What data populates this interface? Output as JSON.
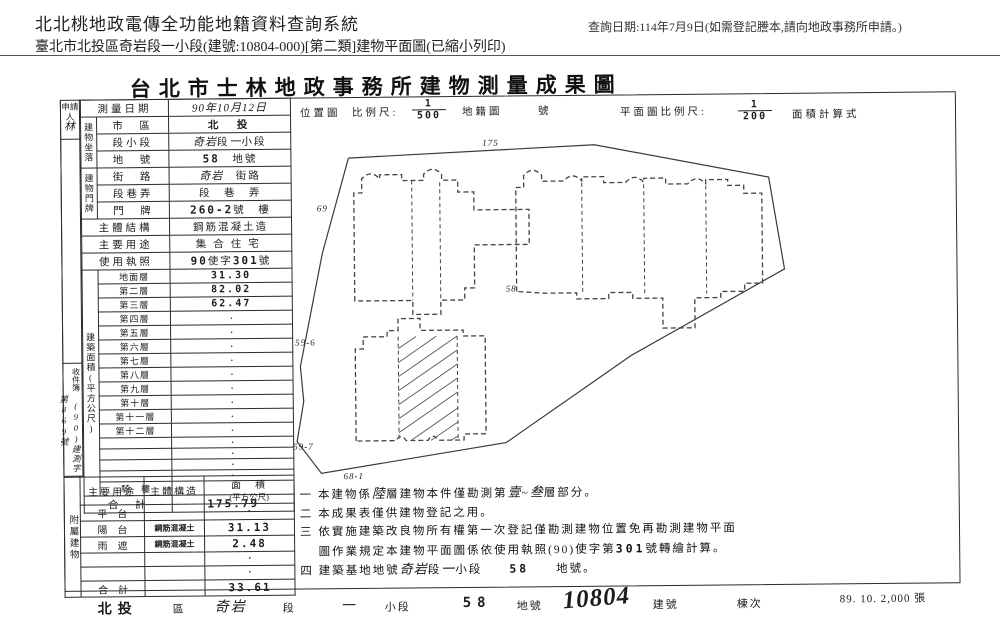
{
  "page_header": {
    "system_title": "北北桃地政電傳全功能地籍資料查詢系統",
    "subtitle": "臺北市北投區奇岩段一小段(建號:10804-000)[第二類]建物平面圖(已縮小列印)",
    "query_date_note": "查詢日期:114年7月9日(如需登記謄本,請向地政事務所申請。)"
  },
  "form": {
    "title": "台北市士林地政事務所建物測量成果圖",
    "applicant": {
      "label": "申請人",
      "name": "林"
    },
    "receipt": {
      "label": "收件簿",
      "number": "(90)建測字第869號"
    },
    "main_table": {
      "rows": [
        {
          "label": "測量日期",
          "wide": true,
          "segs": [
            {
              "t": "90年10月12日",
              "s": "hand"
            }
          ]
        },
        {
          "group": {
            "label": "建物坐落",
            "span": 3
          },
          "label": "市　區",
          "segs": [
            {
              "t": "北　投",
              "s": "bold"
            }
          ]
        },
        {
          "label": "段小段",
          "segs": [
            {
              "t": "奇岩",
              "s": "hand"
            },
            {
              "t": "段",
              "s": "print"
            },
            {
              "t": "一",
              "s": "hand"
            },
            {
              "t": "小段",
              "s": "print"
            }
          ]
        },
        {
          "label": "地　號",
          "segs": [
            {
              "t": "58",
              "s": "mono"
            },
            {
              "t": "　地號",
              "s": "print"
            }
          ]
        },
        {
          "group": {
            "label": "建物門牌",
            "span": 3
          },
          "label": "街　路",
          "segs": [
            {
              "t": "奇岩",
              "s": "hand"
            },
            {
              "t": "　街路",
              "s": "print"
            }
          ]
        },
        {
          "label": "段巷弄",
          "segs": [
            {
              "t": "段　巷　弄",
              "s": "print"
            }
          ]
        },
        {
          "label": "門　牌",
          "segs": [
            {
              "t": "260-2",
              "s": "mono"
            },
            {
              "t": "號　樓",
              "s": "print"
            }
          ]
        },
        {
          "label": "主體結構",
          "wide": true,
          "segs": [
            {
              "t": "鋼筋混凝土造",
              "s": "print"
            }
          ]
        },
        {
          "label": "主要用途",
          "wide": true,
          "segs": [
            {
              "t": "集合住宅",
              "s": "spread"
            }
          ]
        },
        {
          "label": "使用執照",
          "wide": true,
          "segs": [
            {
              "t": "90",
              "s": "mono"
            },
            {
              "t": "使字",
              "s": "print"
            },
            {
              "t": "301",
              "s": "mono"
            },
            {
              "t": "號",
              "s": "print"
            }
          ]
        },
        {
          "group": {
            "label": "建築面積(平方公尺)",
            "span": 17
          },
          "label": "地面層",
          "c": 1,
          "segs": [
            {
              "t": "31.30",
              "s": "mono"
            }
          ]
        },
        {
          "label": "第二層",
          "c": 1,
          "segs": [
            {
              "t": "82.02",
              "s": "mono"
            }
          ]
        },
        {
          "label": "第三層",
          "c": 1,
          "segs": [
            {
              "t": "62.47",
              "s": "mono"
            }
          ]
        },
        {
          "label": "第四層",
          "c": 1,
          "segs": [
            {
              "t": "·",
              "s": "dot"
            }
          ]
        },
        {
          "label": "第五層",
          "c": 1,
          "segs": [
            {
              "t": "·",
              "s": "dot"
            }
          ]
        },
        {
          "label": "第六層",
          "c": 1,
          "segs": [
            {
              "t": "·",
              "s": "dot"
            }
          ]
        },
        {
          "label": "第七層",
          "c": 1,
          "segs": [
            {
              "t": "·",
              "s": "dot"
            }
          ]
        },
        {
          "label": "第八層",
          "c": 1,
          "segs": [
            {
              "t": "·",
              "s": "dot"
            }
          ]
        },
        {
          "label": "第九層",
          "c": 1,
          "segs": [
            {
              "t": "·",
              "s": "dot"
            }
          ]
        },
        {
          "label": "第十層",
          "c": 1,
          "segs": [
            {
              "t": "·",
              "s": "dot"
            }
          ]
        },
        {
          "label": "第十一層",
          "c": 1,
          "segs": [
            {
              "t": "·",
              "s": "dot"
            }
          ]
        },
        {
          "label": "第十二層",
          "c": 1,
          "segs": [
            {
              "t": "·",
              "s": "dot"
            }
          ]
        },
        {
          "label": "",
          "c": 1,
          "segs": [
            {
              "t": "·",
              "s": "dot"
            }
          ]
        },
        {
          "label": "",
          "c": 1,
          "segs": [
            {
              "t": "·",
              "s": "dot"
            }
          ]
        },
        {
          "label": "",
          "c": 1,
          "segs": [
            {
              "t": "·",
              "s": "dot"
            }
          ]
        },
        {
          "label": "",
          "c": 1,
          "segs": [
            {
              "t": "·",
              "s": "dot"
            }
          ]
        },
        {
          "label": "騎　樓",
          "c": 1,
          "segs": [
            {
              "t": "·",
              "s": "dot"
            }
          ]
        },
        {
          "label": "合　計",
          "wide": true,
          "segs": [
            {
              "t": "175.79",
              "s": "mono"
            }
          ]
        }
      ]
    },
    "annex_table": {
      "side_label": "附屬建物",
      "headers": {
        "usage": "主要用途",
        "structure": "主體構造",
        "area": "面　積",
        "area_unit": "(平方公尺)"
      },
      "rows": [
        {
          "usage": "平　台",
          "structure": "",
          "area": "·",
          "mono": false
        },
        {
          "usage": "陽　台",
          "structure": "鋼筋混凝土",
          "area": "31.13",
          "mono": true
        },
        {
          "usage": "雨　遮",
          "structure": "鋼筋混凝土",
          "area": "2.48",
          "mono": true
        },
        {
          "usage": "",
          "structure": "",
          "area": "·",
          "mono": false
        },
        {
          "usage": "",
          "structure": "",
          "area": "·",
          "mono": false
        },
        {
          "usage": "合　計",
          "structure": "",
          "area": "33.61",
          "mono": true
        }
      ]
    },
    "plan_header": {
      "location_map": "位置圖",
      "scale_label": "比例尺:",
      "location_scale": {
        "num": "1",
        "den": "500"
      },
      "cadastral_map": "地籍圖",
      "cadastral_no": "號",
      "plan_scale_label": "平面圖比例尺:",
      "plan_scale": {
        "num": "1",
        "den": "200"
      },
      "area_calc": "面積計算式"
    },
    "map_labels": [
      {
        "text": "175",
        "x": 192,
        "y": 42
      },
      {
        "text": "69",
        "x": 26,
        "y": 106
      },
      {
        "text": "59-6",
        "x": 3,
        "y": 240
      },
      {
        "text": "59-7",
        "x": 0,
        "y": 344
      },
      {
        "text": "68-1",
        "x": 50,
        "y": 374
      },
      {
        "text": "58",
        "x": 214,
        "y": 188
      }
    ],
    "notes": [
      [
        {
          "t": "一 本建物係 ",
          "s": "print"
        },
        {
          "t": "陸",
          "s": "hand"
        },
        {
          "t": " 層建物本件僅勘測第",
          "s": "print"
        },
        {
          "t": "壹",
          "s": "hand"
        },
        {
          "t": "~",
          "s": "print"
        },
        {
          "t": "叁",
          "s": "hand"
        },
        {
          "t": " 層部分。",
          "s": "print"
        }
      ],
      [
        {
          "t": "二 本成果表僅供建物登記之用。",
          "s": "print"
        }
      ],
      [
        {
          "t": "三 依實施建築改良物所有權第一次登記僅勘測建物位置免再勘測建物平面",
          "s": "print"
        }
      ],
      [
        {
          "t": "　 圖作業規定本建物平面圖係依使用執照(90)使字第 ",
          "s": "print"
        },
        {
          "t": "301",
          "s": "mono"
        },
        {
          "t": " 號轉繪計算。",
          "s": "print"
        }
      ],
      [
        {
          "t": "四 建築基地地號 ",
          "s": "print"
        },
        {
          "t": "奇岩",
          "s": "hand"
        },
        {
          "t": " 段 ",
          "s": "print"
        },
        {
          "t": "一",
          "s": "hand"
        },
        {
          "t": " 小段　　",
          "s": "print"
        },
        {
          "t": "58",
          "s": "mono"
        },
        {
          "t": "　　地號。",
          "s": "print"
        }
      ]
    ],
    "footer_strip": {
      "segments": [
        {
          "t": "北投",
          "s": "bold"
        },
        {
          "t": "區",
          "s": "plain"
        },
        {
          "t": "奇岩",
          "s": "hand"
        },
        {
          "t": "段",
          "s": "plain"
        },
        {
          "t": "一",
          "s": "hand"
        },
        {
          "t": "小段",
          "s": "plain"
        },
        {
          "t": "58",
          "s": "bold"
        },
        {
          "t": "地號",
          "s": "plain"
        },
        {
          "t": "10804",
          "s": "marker"
        },
        {
          "t": "建號",
          "s": "plain"
        },
        {
          "t": "棟次",
          "s": "plain"
        }
      ],
      "print_info": "89. 10. 2,000 張"
    }
  }
}
